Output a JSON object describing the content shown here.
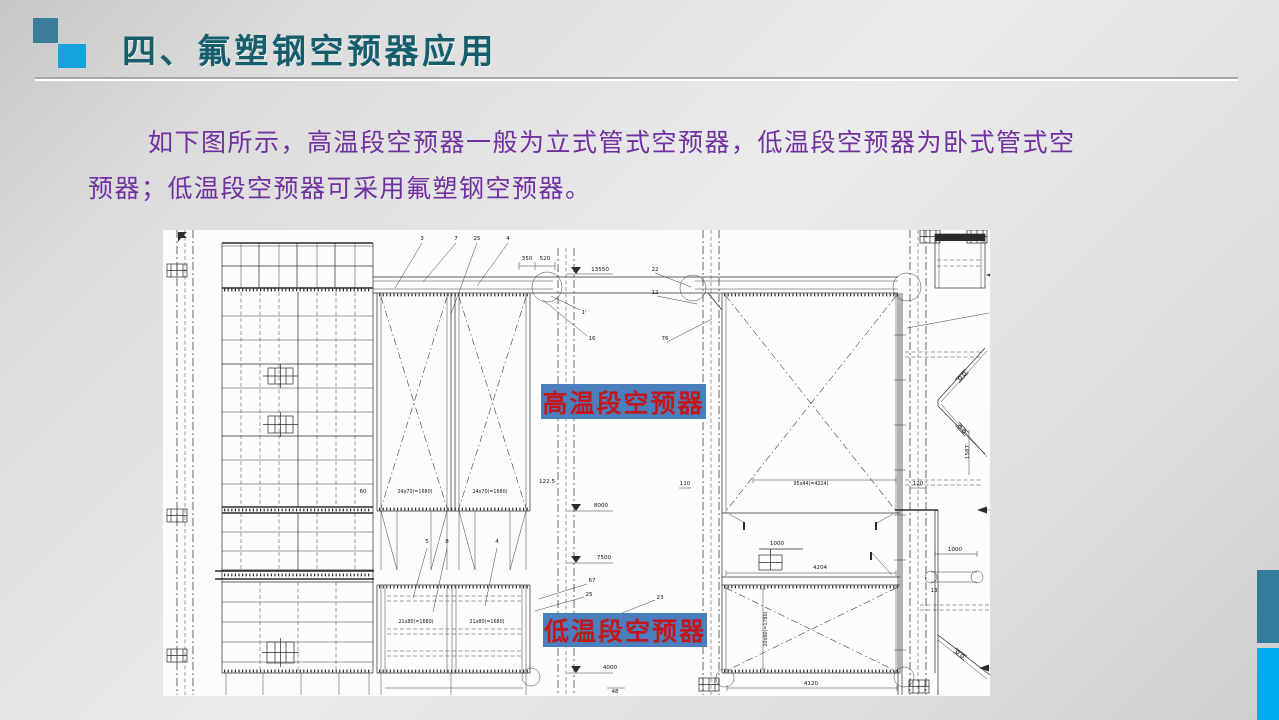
{
  "colors": {
    "title_color": "#175e6d",
    "square_dark": "#3a7d98",
    "square_light": "#14a3db",
    "body_text": "#7030a0",
    "label_bg": "#4b7ebd",
    "label_text": "#c2181b",
    "accent_teal": "#337c9c",
    "accent_blue": "#00aeef",
    "divider_dark": "#a9a9a9",
    "divider_light": "#ffffff",
    "paper": "#fcfcfc"
  },
  "header": {
    "title": "四、氟塑钢空预器应用"
  },
  "body": {
    "line1": "如下图所示，高温段空预器一般为立式管式空预器，低温段空预器为卧式管式空",
    "line2": "预器；低温段空预器可采用氟塑钢空预器。"
  },
  "diagram": {
    "high_temp_label": "高温段空预器",
    "low_temp_label": "低温段空预器",
    "annotations": [
      {
        "t": "3",
        "x": 259,
        "y": 10
      },
      {
        "t": "7",
        "x": 293,
        "y": 10
      },
      {
        "t": "25",
        "x": 314,
        "y": 10
      },
      {
        "t": "4",
        "x": 345,
        "y": 10
      },
      {
        "t": "350",
        "x": 364,
        "y": 30
      },
      {
        "t": "520",
        "x": 382,
        "y": 30
      },
      {
        "t": "13550",
        "x": 437,
        "y": 41
      },
      {
        "t": "1'",
        "x": 421,
        "y": 84
      },
      {
        "t": "16",
        "x": 429,
        "y": 110
      },
      {
        "t": "22",
        "x": 492,
        "y": 41
      },
      {
        "t": "12",
        "x": 492,
        "y": 64
      },
      {
        "t": "76",
        "x": 502,
        "y": 110
      },
      {
        "t": "60",
        "x": 200,
        "y": 263
      },
      {
        "t": "24x70(=1680)",
        "x": 252,
        "y": 263
      },
      {
        "t": "24x70(=1680)",
        "x": 327,
        "y": 263
      },
      {
        "t": "122.5",
        "x": 384,
        "y": 253
      },
      {
        "t": "8000",
        "x": 438,
        "y": 277
      },
      {
        "t": "7500",
        "x": 441,
        "y": 329
      },
      {
        "t": "5",
        "x": 264,
        "y": 313
      },
      {
        "t": "8",
        "x": 284,
        "y": 313
      },
      {
        "t": "4",
        "x": 334,
        "y": 313
      },
      {
        "t": "67",
        "x": 429,
        "y": 352
      },
      {
        "t": "25",
        "x": 426,
        "y": 366
      },
      {
        "t": "23",
        "x": 497,
        "y": 369
      },
      {
        "t": "21x80(=1680)",
        "x": 253,
        "y": 393
      },
      {
        "t": "21x80(=1680)",
        "x": 324,
        "y": 393
      },
      {
        "t": "110",
        "x": 522,
        "y": 255
      },
      {
        "t": "95x44(=4224)",
        "x": 648,
        "y": 255
      },
      {
        "t": "1000",
        "x": 614,
        "y": 315
      },
      {
        "t": "4204",
        "x": 657,
        "y": 339
      },
      {
        "t": "20x90(=1780)",
        "x": 604,
        "y": 399,
        "r": -90
      },
      {
        "t": "4120",
        "x": 648,
        "y": 455
      },
      {
        "t": "48",
        "x": 452,
        "y": 463
      },
      {
        "t": "4000",
        "x": 447,
        "y": 439
      },
      {
        "t": "120",
        "x": 755,
        "y": 255
      },
      {
        "t": "1000",
        "x": 792,
        "y": 321
      },
      {
        "t": "13",
        "x": 771,
        "y": 362
      },
      {
        "t": "1587",
        "x": 806,
        "y": 222,
        "r": -90
      }
    ]
  }
}
